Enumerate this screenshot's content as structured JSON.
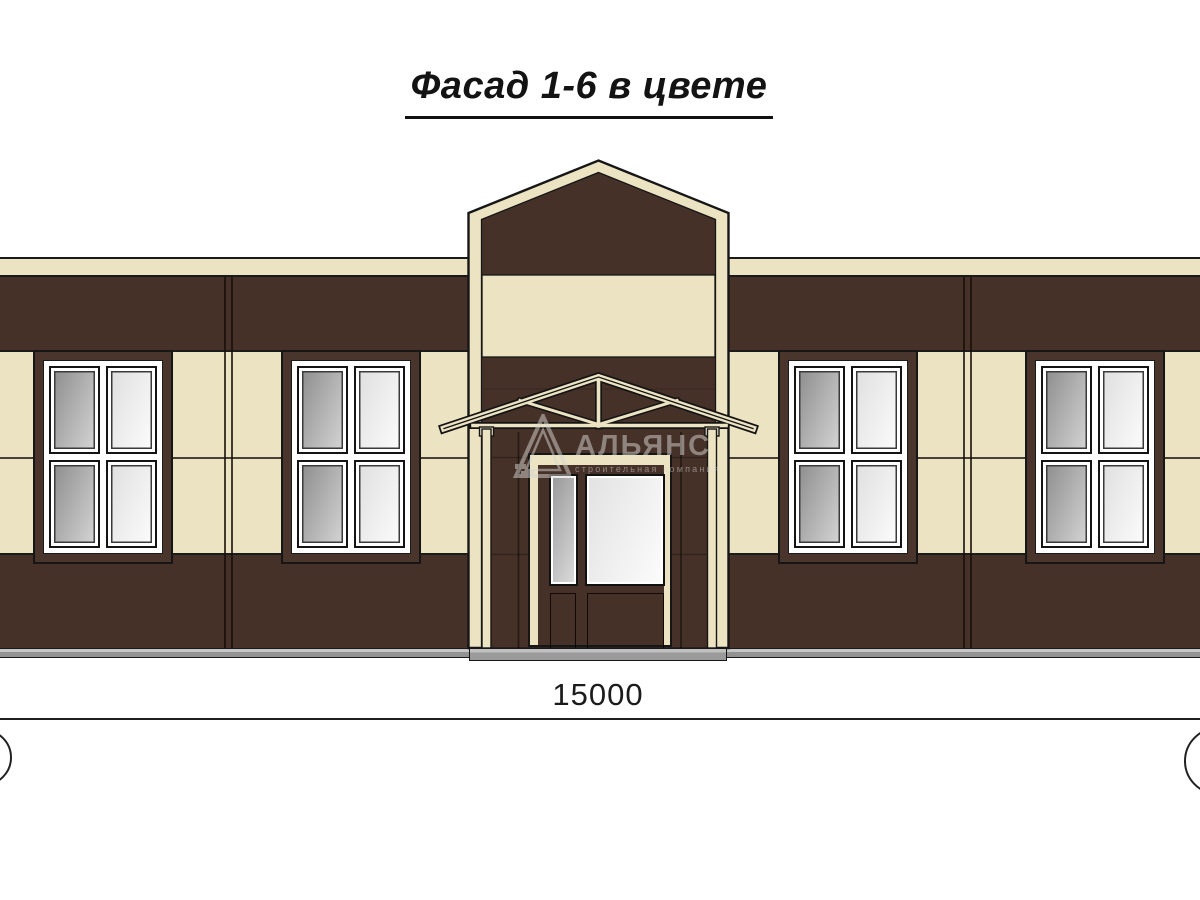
{
  "title": {
    "text": "Фасад 1-6 в цвете"
  },
  "dimension": {
    "value": "15000"
  },
  "watermark": {
    "name": "АЛЬЯНС",
    "tagline": "строительная компания",
    "logo": "alliance-triangle-logo"
  },
  "colors": {
    "wall_dark": "#463129",
    "wall_cream": "#ece3c3",
    "frame_brown": "#4a352d",
    "outline_black": "#1a1a1a",
    "plinth_grey": "#929292",
    "plinth_light": "#c6c6c6",
    "glass_a1": "#8a8a8a",
    "glass_a2": "#d8d8d8",
    "glass_b1": "#dedede",
    "glass_b2": "#fdfdfd"
  }
}
